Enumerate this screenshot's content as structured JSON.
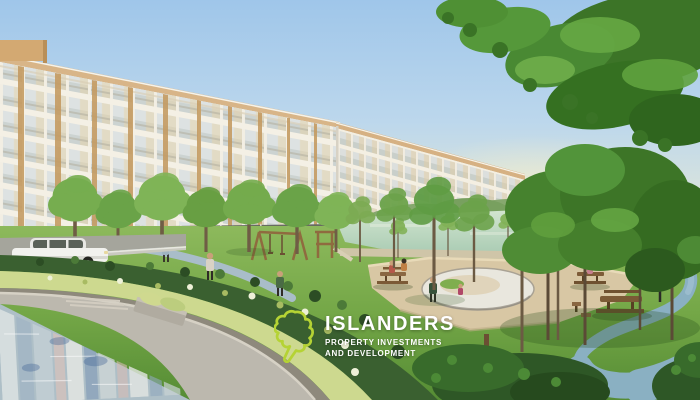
{
  "logo": {
    "title": "ISLANDERS",
    "subtitle_line1": "PROPERTY INVESTMENTS",
    "subtitle_line2": "AND DEVELOPMENT",
    "icon": "island-outline-icon",
    "icon_color": "#b5d334",
    "text_color": "#ffffff"
  },
  "scene": {
    "type": "architectural-rendering",
    "description": "Low-rise cream condominium buildings with wood accents around a landscaped park: lagoon, lawns, jogging path, picnic tables, playground, reflecting swimming pool, road with white car, many trees and hedges.",
    "elements": [
      "condominium-building-left-wing",
      "condominium-building-right-wing",
      "lagoon",
      "distant-clubhouse",
      "park-lawn",
      "sand-plaza",
      "white-playground-pad",
      "blue-jogging-path",
      "picnic-tables",
      "wooden-playground",
      "street-lamp",
      "pedestrians",
      "jogger",
      "white-car",
      "road",
      "hedge-rows",
      "flowering-shrubs",
      "swimming-pool-reflection",
      "overhanging-tree-canopy"
    ],
    "palette": {
      "sky_blue": "#a9cdec",
      "building_cream": "#f3efe6",
      "wood_accent": "#c49a60",
      "foliage_green": "#4a8a33",
      "grass_green": "#7fae4e",
      "lagoon_green": "#bcd9bf",
      "path_blue": "#8ab0c2",
      "sand_beige": "#d9c7a3",
      "pool_water": "#aebfc7",
      "logo_lime": "#b5d334",
      "logo_white": "#ffffff"
    }
  }
}
